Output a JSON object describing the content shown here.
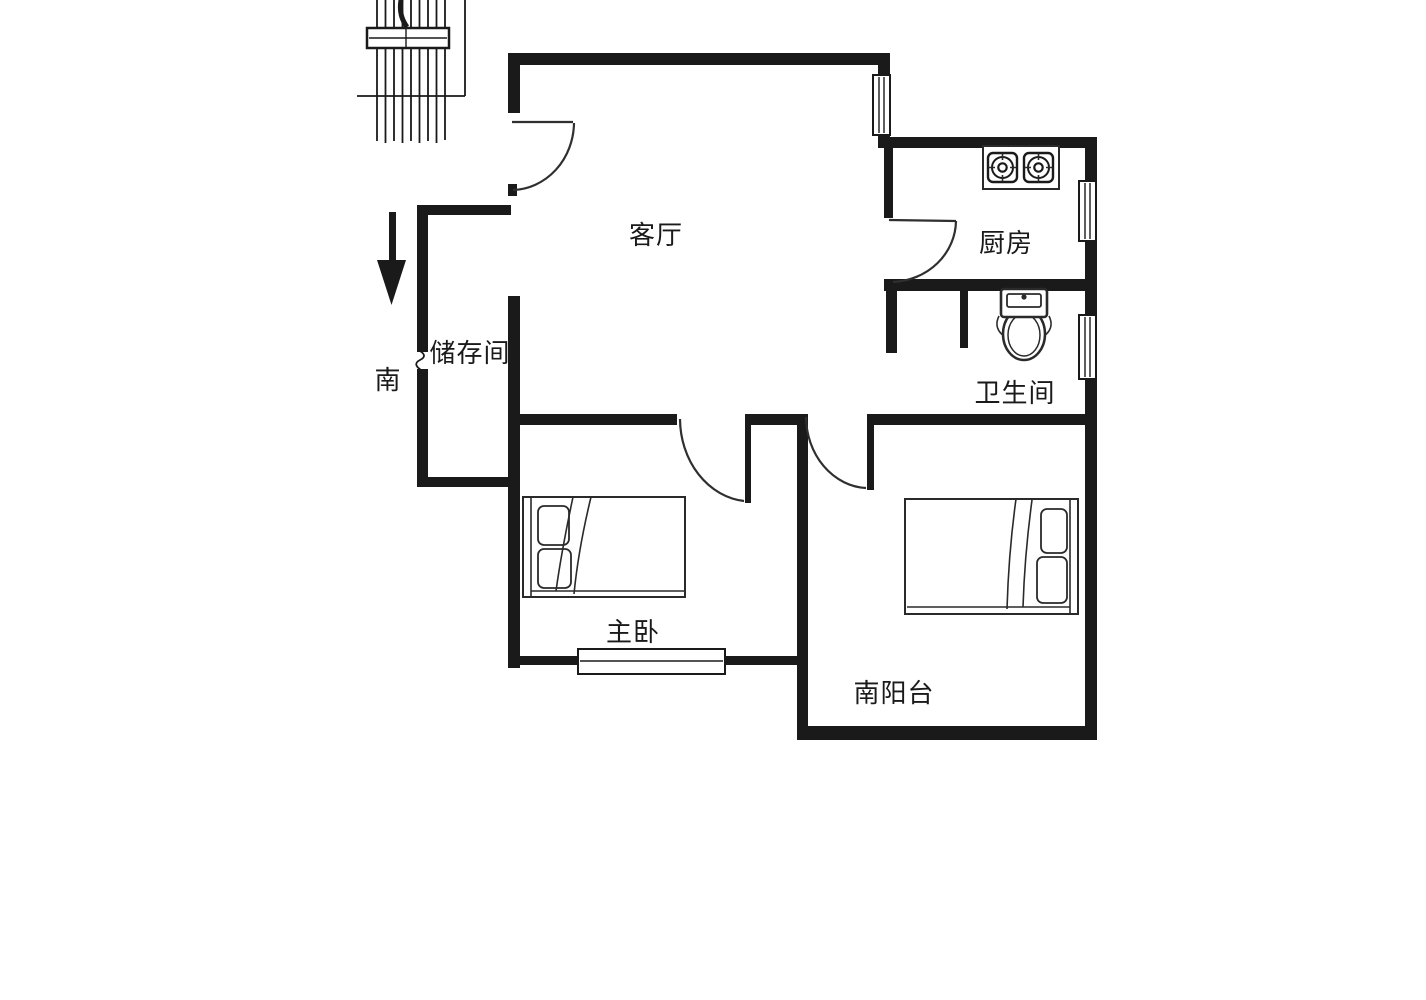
{
  "plan": {
    "type": "apartment-floor-plan",
    "orientation_note": "south-facing arrow at left"
  },
  "colors": {
    "background": "#ffffff",
    "line": "#1a1a1a"
  },
  "compass": {
    "direction_label": "南",
    "icon": "south-arrow-icon"
  },
  "rooms": [
    {
      "id": "living-room",
      "label": "客厅"
    },
    {
      "id": "kitchen",
      "label": "厨房"
    },
    {
      "id": "storage-room",
      "label": "储存间"
    },
    {
      "id": "bathroom",
      "label": "卫生间"
    },
    {
      "id": "master-bedroom",
      "label": "主卧"
    },
    {
      "id": "south-balcony",
      "label": "南阳台"
    }
  ],
  "icons": {
    "staircase": "staircase-icon",
    "south_arrow": "south-arrow-icon",
    "stove": "stove-icon",
    "toilet": "toilet-icon",
    "master_bed": "bed-icon",
    "balcony_bed": "bed-icon",
    "door": "door-arc-icon",
    "window": "window-icon"
  }
}
